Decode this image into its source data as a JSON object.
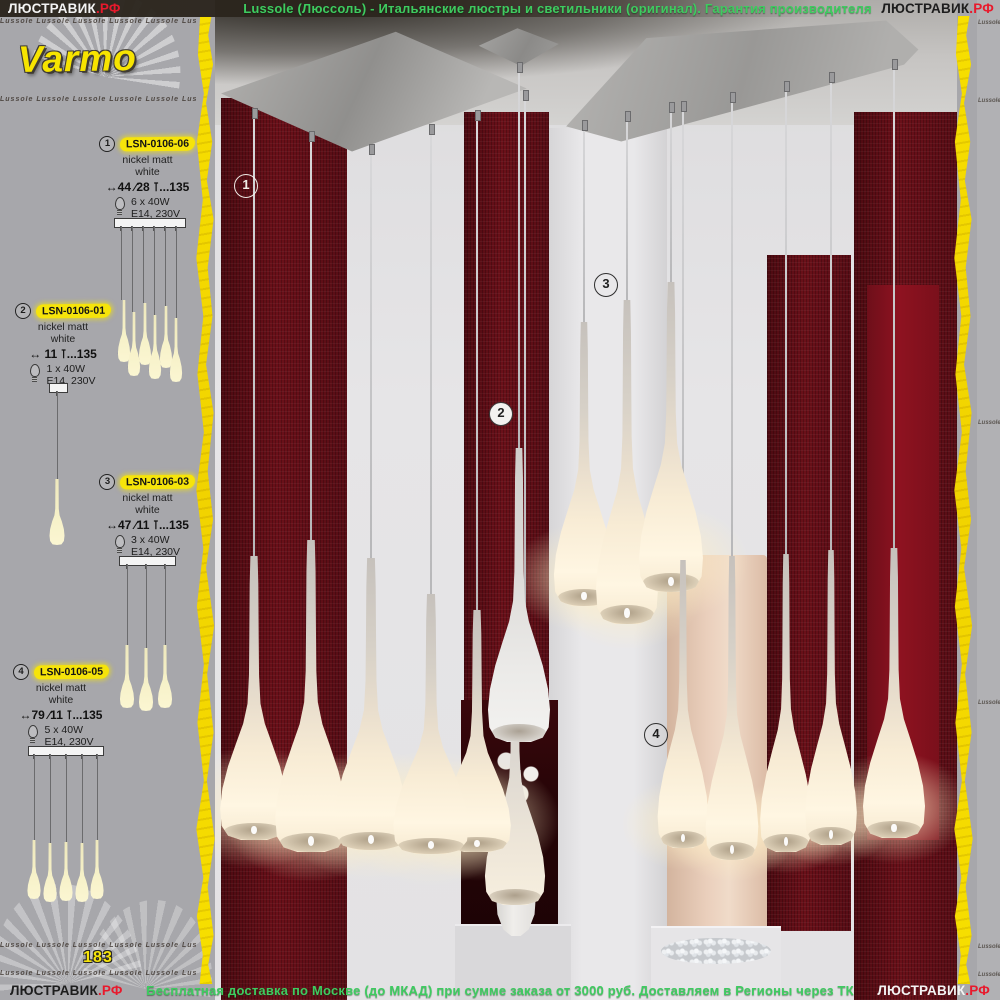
{
  "site": {
    "brand": "ЛЮСТРАВИК",
    "tld": ".РФ"
  },
  "top_banner": {
    "text": "Lussole (Люссоль) - Итальянские люстры и светильники (оригинал). Гарантия производителя"
  },
  "bottom_banner": {
    "text": "Бесплатная доставка по Москве (до МКАД) при сумме заказа от 3000 руб. Доставляем в Регионы через ТК"
  },
  "collection": {
    "name": "Varmo",
    "brand_watermark": "Lussole",
    "page_number": "183"
  },
  "products": [
    {
      "number": "1",
      "code": "LSN-0106-06",
      "finish": "nickel matt",
      "shade_color": "white",
      "dimensions": "↔44 ∕28 ⊺...135",
      "bulbs": "6 x 40W",
      "socket": "E14, 230V"
    },
    {
      "number": "2",
      "code": "LSN-0106-01",
      "finish": "nickel matt",
      "shade_color": "white",
      "dimensions": "↔ 11 ⊺...135",
      "bulbs": "1 x 40W",
      "socket": "E14, 230V"
    },
    {
      "number": "3",
      "code": "LSN-0106-03",
      "finish": "nickel matt",
      "shade_color": "white",
      "dimensions": "↔47 ∕11 ⊺...135",
      "bulbs": "3 x 40W",
      "socket": "E14, 230V"
    },
    {
      "number": "4",
      "code": "LSN-0106-05",
      "finish": "nickel matt",
      "shade_color": "white",
      "dimensions": "↔79 ∕11 ⊺...135",
      "bulbs": "5 x 40W",
      "socket": "E14, 230V"
    }
  ],
  "photo": {
    "markers": [
      "1",
      "2",
      "3",
      "4"
    ]
  },
  "colors": {
    "accent_yellow": "#f6e40a",
    "brand_red": "#e8192c",
    "banner_green": "#3ecb60",
    "wall_red": "#5c0d16"
  }
}
